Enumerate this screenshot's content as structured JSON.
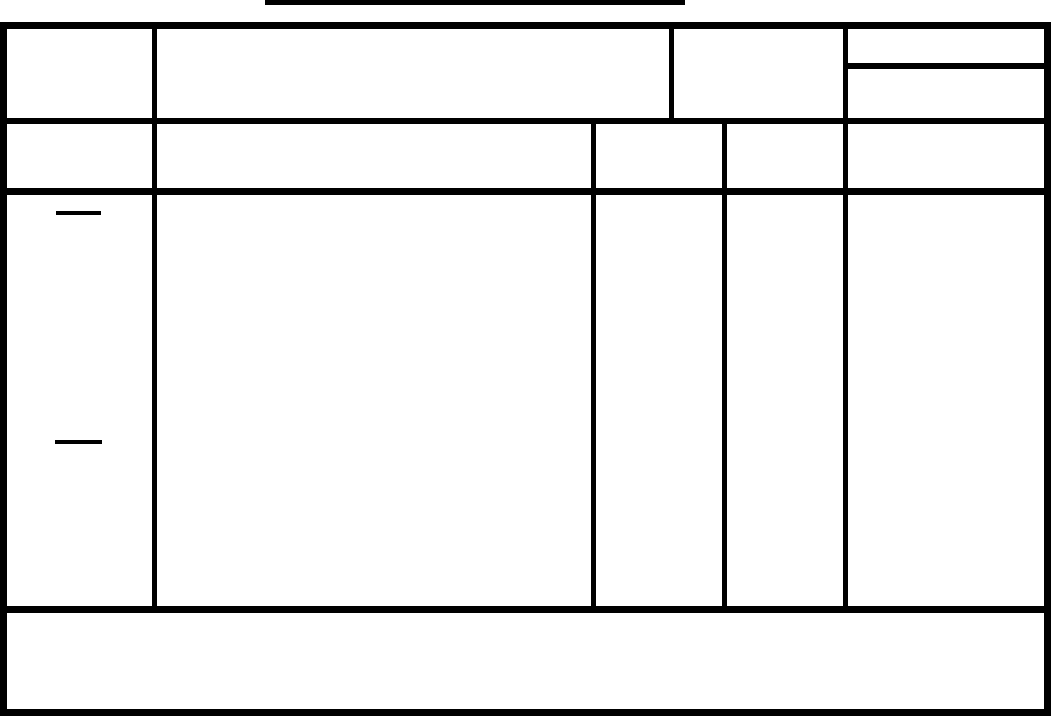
{
  "palette": {
    "ink": "#000000",
    "paper": "#ffffff"
  },
  "title": {
    "text": "",
    "underlined": true
  },
  "table": {
    "header_row_1": {
      "cell_1": "",
      "cell_2": "",
      "cell_3": "",
      "cell_4_top": "",
      "cell_4_bottom": ""
    },
    "header_row_2": {
      "col_1": "",
      "col_2": "",
      "col_3": "",
      "col_4": "",
      "col_5": ""
    },
    "body": {
      "col_1": "",
      "col_2": "",
      "col_3": "",
      "col_4": "",
      "col_5": "",
      "ditto_mark_count": 2
    },
    "footer": {
      "text": ""
    }
  }
}
